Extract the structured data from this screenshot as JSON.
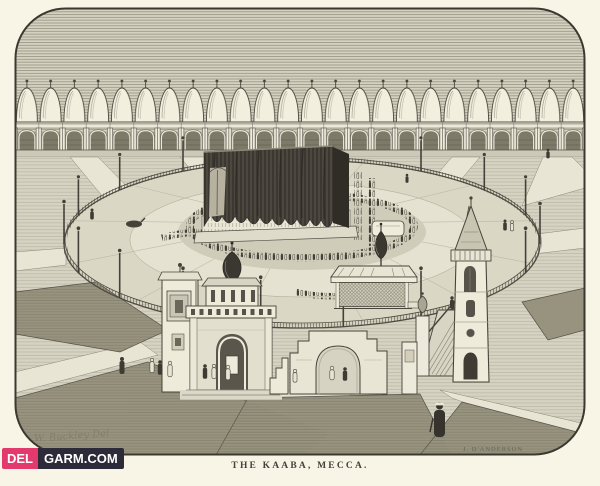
{
  "artwork": {
    "caption": "THE KAABA, MECCA.",
    "artist_signature": "W. Buckley Del",
    "engraver_signature": "J. D'ANDERSON"
  },
  "watermark": {
    "prefix": "DEL",
    "suffix": "GARM.COM"
  },
  "colors": {
    "paper": "#f8f5e7",
    "ink": "#47443a",
    "kiswah_dark": "#44413a",
    "watermark_pink": "#e23a6d",
    "watermark_dark": "#2d2a3a",
    "watermark_text": "#ffffff"
  }
}
